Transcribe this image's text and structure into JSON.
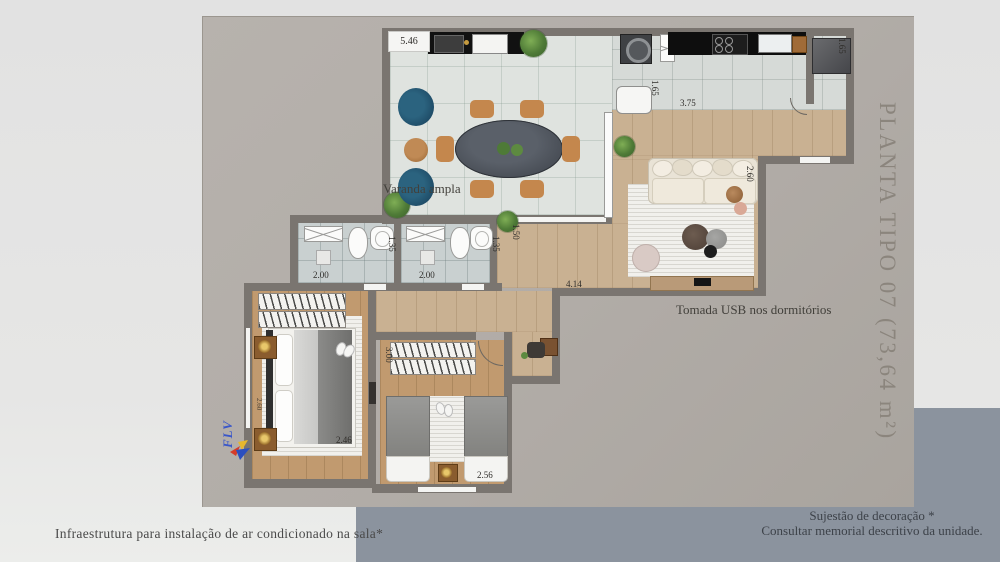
{
  "title": "PLANTA TIPO 07  (73,64 m²)",
  "watermark": "FLV",
  "plan_labels": {
    "varanda": "Varanda ampla",
    "usb": "Tomada USB nos dormitórios"
  },
  "footnotes": {
    "left": "Infraestrutura para instalação de ar condicionado na sala*",
    "right_line1": "Sujestão de decoração *",
    "right_line2": "Consultar memorial descritivo da unidade."
  },
  "dimensions": {
    "varanda_width": "5.46",
    "servico_depth": "1.65",
    "cozinha_width": "3.75",
    "geladeira_nook": "1.65",
    "sala_depth": "2.60",
    "hall_depth": "1.50",
    "banheiro1_depth": "1.35",
    "banheiro1_width": "2.00",
    "banheiro2_depth": "1.35",
    "banheiro2_width": "2.00",
    "sala_length": "4.14",
    "dorm1_width": "2.46",
    "dorm1_depth": "2.60",
    "dorm2_depth": "3.00",
    "dorm2_width": "2.56"
  },
  "colors": {
    "background": "#e4e4e3",
    "panel": "#b1aca7",
    "bottom_band": "#8b939e",
    "walls": "#7a7570",
    "wood_floor": "#c9b192",
    "balcony_tile": "#dfe3df",
    "bath_tile": "#c9d0d0",
    "counter": "#111111",
    "armchair_blue": "#1e4b66",
    "title_text": "#8b857d"
  }
}
